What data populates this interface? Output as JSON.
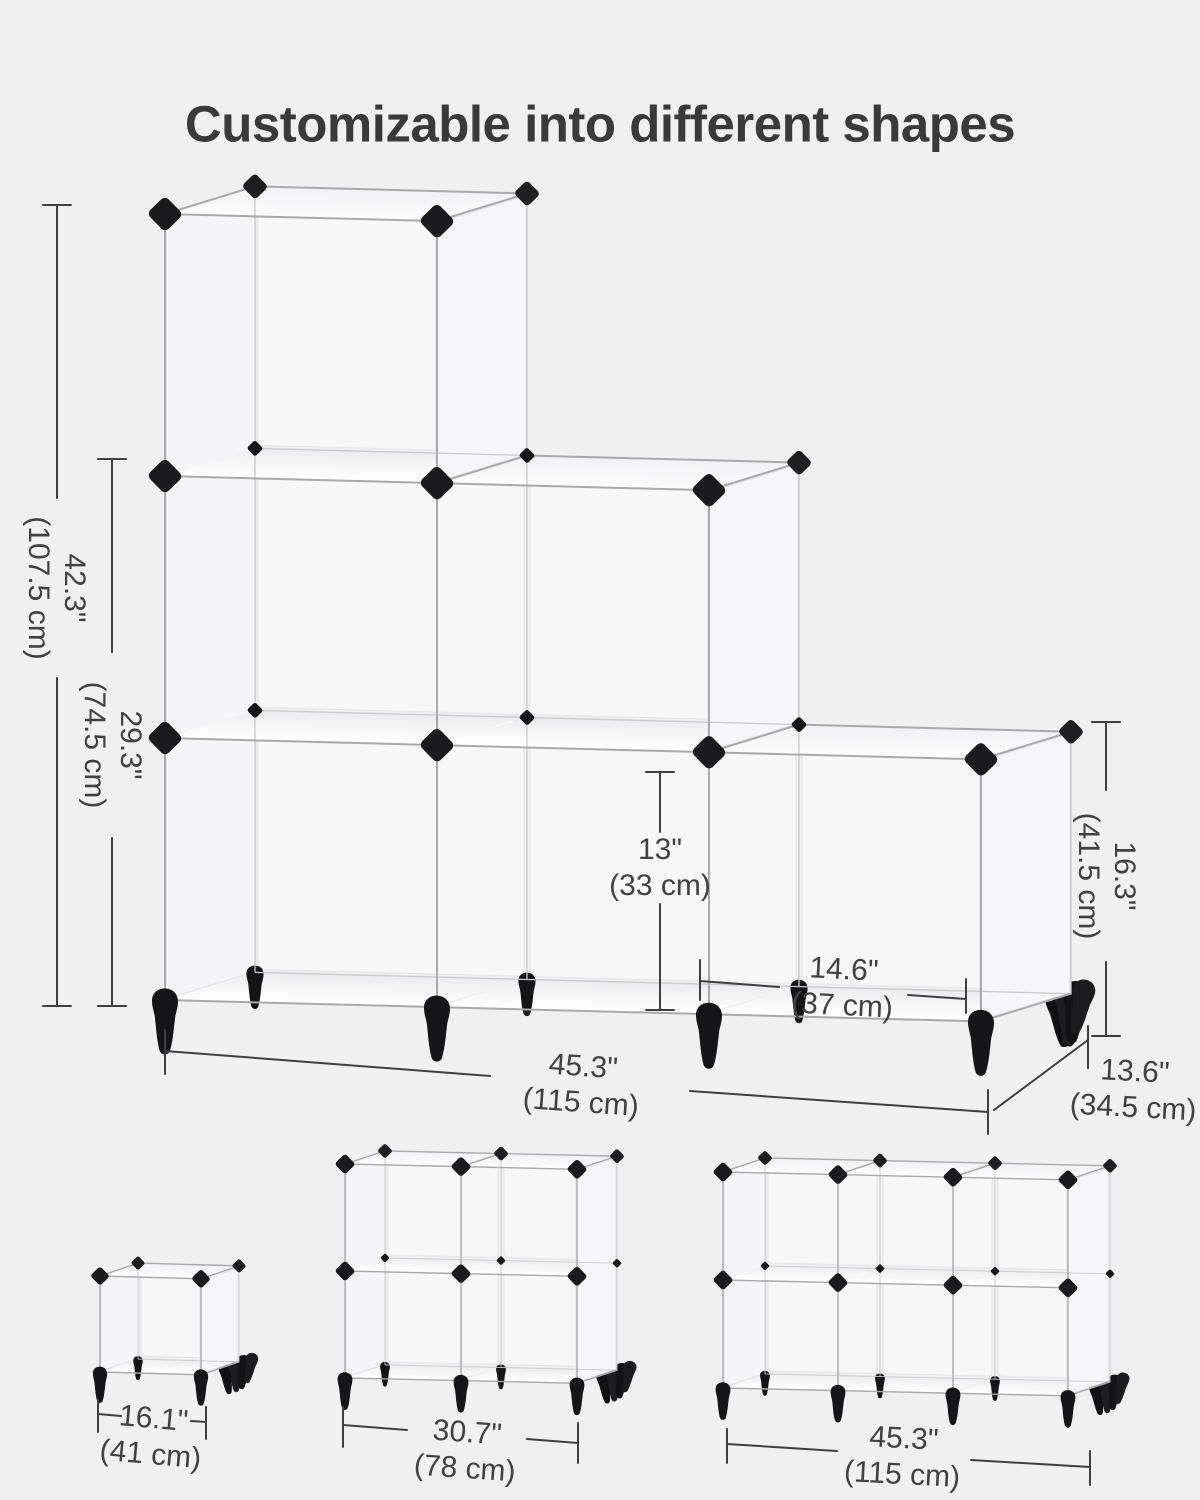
{
  "title": "Customizable into different shapes",
  "colors": {
    "background": "#f0f0f1",
    "panel_white": "#f8f8f9",
    "wire_gray": "#a9a9ab",
    "connector_black": "#1b1b1d",
    "text_dark": "#3a3a3a",
    "dimension_text": "#414141"
  },
  "main_unit": {
    "name": "6-cube staircase organizer",
    "dimensions": {
      "total_height": {
        "in": "42.3\"",
        "cm": "(107.5 cm)"
      },
      "two_tier_height": {
        "in": "29.3\"",
        "cm": "(74.5 cm)"
      },
      "cube_inner_height": {
        "in": "13\"",
        "cm": "(33 cm)"
      },
      "cube_inner_width": {
        "in": "14.6\"",
        "cm": "(37 cm)"
      },
      "one_tier_height": {
        "in": "16.3\"",
        "cm": "(41.5 cm)"
      },
      "total_width": {
        "in": "45.3\"",
        "cm": "(115 cm)"
      },
      "total_depth": {
        "in": "13.6\"",
        "cm": "(34.5 cm)"
      }
    }
  },
  "variants": [
    {
      "name": "single cube",
      "width_in": "16.1\"",
      "width_cm": "(41 cm)"
    },
    {
      "name": "2 x 2 cubes",
      "width_in": "30.7\"",
      "width_cm": "(78 cm)"
    },
    {
      "name": "3 x 2 cubes",
      "width_in": "45.3\"",
      "width_cm": "(115 cm)"
    }
  ]
}
